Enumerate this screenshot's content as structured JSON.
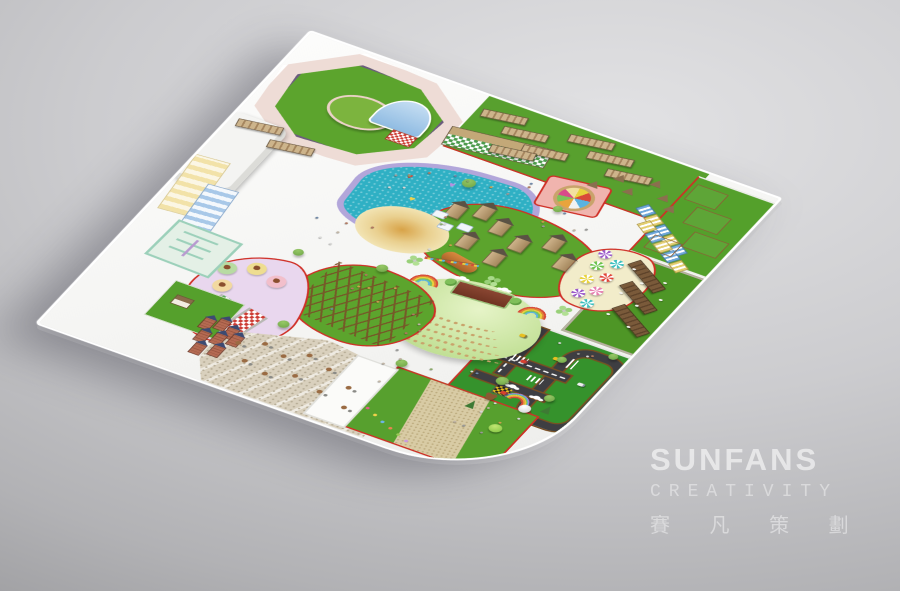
{
  "scene": {
    "description": "Isometric 3D master-plan rendering of a children's theme park on a white base plate over a gray studio background"
  },
  "watermark": {
    "brand": "SUNFANS",
    "subtitle": "CREATIVITY",
    "chinese": "賽 凡 策 劃"
  },
  "palette": {
    "background_light": "#e2e2e4",
    "background_dark": "#a2a2a5",
    "plate_white": "#f8f8f7",
    "path_outline_red": "#cf2f26",
    "grass_green": "#5ca42d",
    "grass_dark": "#35922c",
    "pool_water_teal": "#2fb0c4",
    "pool_rim_lavender": "#b2a6da",
    "track_pink": "#eedcd6",
    "sand_cream": "#ecd9a0",
    "picnic_lavender": "#e9d7ee",
    "gravel_beige": "#d9d0bd",
    "wood_tan": "#c3a878",
    "road_asphalt": "#3e3e42"
  },
  "zones": [
    {
      "name": "sports-field",
      "kind": "green field with circular mound and pink running track"
    },
    {
      "name": "street-market-lawn",
      "kind": "lawn with rows of wooden market pergolas"
    },
    {
      "name": "farm-paddock",
      "kind": "animal pens with log fences and huts"
    },
    {
      "name": "splash-pool",
      "kind": "teardrop pool with heart floats"
    },
    {
      "name": "castle-playground",
      "kind": "wooden tower castles with bridges and slides"
    },
    {
      "name": "sand-play-circle",
      "kind": "round sand play area"
    },
    {
      "name": "carousel-plaza",
      "kind": "carousel on pink mat"
    },
    {
      "name": "striped-stall-arc",
      "kind": "blue and yellow striped canopy stalls"
    },
    {
      "name": "umbrella-cafe-terrace",
      "kind": "cream terrace with pinwheel umbrellas"
    },
    {
      "name": "traffic-town",
      "kind": "mini road-safety driving course with cars"
    },
    {
      "name": "amphitheater",
      "kind": "green oval theater with bench rows and stage"
    },
    {
      "name": "rope-course",
      "kind": "wooden obstacle lattice on lawn"
    },
    {
      "name": "picnic-garden",
      "kind": "lavender zone with pastel tables and checkered picnic tables"
    },
    {
      "name": "gravel-dining-terrace",
      "kind": "stone terrace with scattered tables"
    },
    {
      "name": "mini-brick-castles",
      "kind": "cluster of small brick castles"
    },
    {
      "name": "orchard-field",
      "kind": "green field with diagonal gravel path"
    },
    {
      "name": "park-entrance",
      "kind": "rainbow arch gate with mascots"
    },
    {
      "name": "maze-garden",
      "kind": "mint green hedge maze"
    },
    {
      "name": "canopy-walkways",
      "kind": "striped canopy corridors"
    },
    {
      "name": "entrance-hall",
      "kind": "white roofed building on west edge"
    }
  ]
}
